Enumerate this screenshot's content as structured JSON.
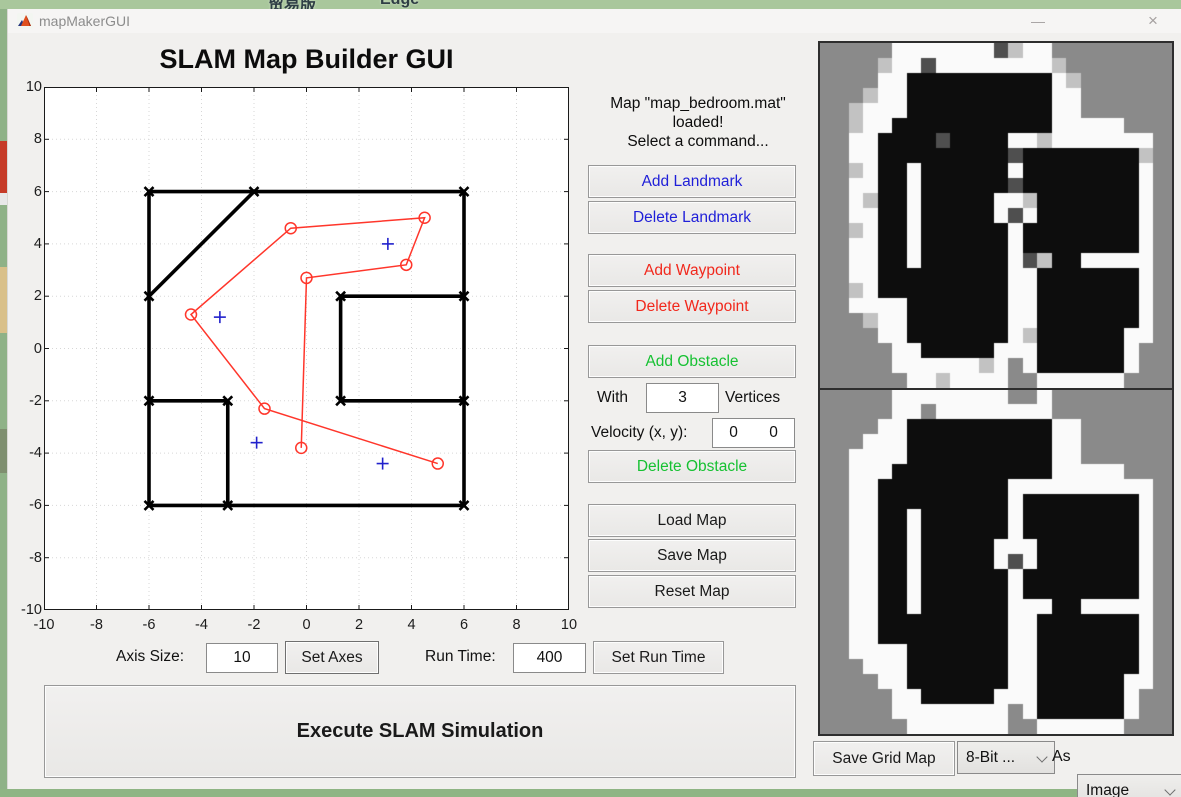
{
  "desktop": {
    "top_text_left": "贸易版",
    "top_text_right": "Edge"
  },
  "window": {
    "title": "mapMakerGUI",
    "minimize": "—",
    "close": "×"
  },
  "app": {
    "title": "SLAM Map Builder GUI"
  },
  "status": {
    "lines": [
      "Map \"map_bedroom.mat\"",
      "loaded!",
      "Select a command..."
    ]
  },
  "landmark_buttons": {
    "add": "Add Landmark",
    "delete": "Delete Landmark"
  },
  "waypoint_buttons": {
    "add": "Add Waypoint",
    "delete": "Delete Waypoint"
  },
  "obstacle": {
    "add": "Add Obstacle",
    "with_label": "With",
    "vertices_value": "3",
    "vertices_label": "Vertices",
    "velocity_label": "Velocity (x, y):",
    "velocity_x": "0",
    "velocity_y": "0",
    "delete": "Delete Obstacle"
  },
  "map_buttons": {
    "load": "Load Map",
    "save": "Save Map",
    "reset": "Reset Map"
  },
  "axis_controls": {
    "axis_size_label": "Axis Size:",
    "axis_size_value": "10",
    "set_axes": "Set Axes",
    "run_time_label": "Run Time:",
    "run_time_value": "400",
    "set_run_time": "Set Run Time"
  },
  "execute": {
    "label": "Execute SLAM Simulation"
  },
  "grid_export": {
    "save": "Save Grid Map",
    "bit_depth": "8-Bit ...",
    "as_label": "As",
    "format": "Image"
  },
  "chart_data": {
    "type": "scatter",
    "title": "",
    "xlabel": "",
    "ylabel": "",
    "xlim": [
      -10,
      10
    ],
    "ylim": [
      -10,
      10
    ],
    "xticks": [
      -10,
      -8,
      -6,
      -4,
      -2,
      0,
      2,
      4,
      6,
      8,
      10
    ],
    "yticks": [
      -10,
      -8,
      -6,
      -4,
      -2,
      0,
      2,
      4,
      6,
      8,
      10
    ],
    "grid": true,
    "walls": [
      [
        -6,
        6,
        6,
        6
      ],
      [
        -6,
        6,
        -6,
        -6
      ],
      [
        6,
        6,
        6,
        -6
      ],
      [
        -6,
        -6,
        6,
        -6
      ],
      [
        -2,
        6,
        -6,
        2
      ],
      [
        1.3,
        2,
        6,
        2
      ],
      [
        1.3,
        2,
        1.3,
        -2
      ],
      [
        1.3,
        -2,
        6,
        -2
      ],
      [
        -6,
        -2,
        -3,
        -2
      ],
      [
        -3,
        -2,
        -3,
        -6
      ]
    ],
    "wall_markers": [
      [
        -6,
        6
      ],
      [
        -2,
        6
      ],
      [
        6,
        6
      ],
      [
        -6,
        2
      ],
      [
        6,
        2
      ],
      [
        1.3,
        2
      ],
      [
        1.3,
        -2
      ],
      [
        6,
        -2
      ],
      [
        -6,
        -2
      ],
      [
        -3,
        -2
      ],
      [
        -6,
        -6
      ],
      [
        -3,
        -6
      ],
      [
        6,
        -6
      ]
    ],
    "waypoints": [
      [
        -0.2,
        -3.8
      ],
      [
        0,
        2.7
      ],
      [
        3.8,
        3.2
      ],
      [
        4.5,
        5.0
      ],
      [
        -0.6,
        4.6
      ],
      [
        -4.4,
        1.3
      ],
      [
        -1.6,
        -2.3
      ],
      [
        5.0,
        -4.4
      ]
    ],
    "landmarks": [
      [
        3.1,
        4.0
      ],
      [
        -3.3,
        1.2
      ],
      [
        -1.9,
        -3.6
      ],
      [
        2.9,
        -4.4
      ]
    ],
    "colors": {
      "wall": "#000000",
      "waypoint": "#ff362b",
      "landmark": "#2121cc",
      "grid": "#d7d7d7",
      "box": "#1a1a1a"
    }
  },
  "grid_maps": {
    "palette": {
      "G": "#8a8a8a",
      "W": "#fafafa",
      "B": "#0d0d0d",
      "D": "#4f4f4f",
      "L": "#c2c2c2"
    },
    "top": [
      "GGGGGWWWWWWWDLWWGGGGGGGG",
      "GGGGLWWDWWWWWWWWLGGGGGGG",
      "GGGGWWBBBBBBBBBBWLGGGGGG",
      "GGGLWWBBBBBBBBBBWWGGGGGG",
      "GGLWWWBBBBBBBBBBWWGGGGGG",
      "GGLWWBBBBBBBBBBBWWWWWGGG",
      "GGWWBBBBDBBBBWWLWWWWWWWG",
      "GGWWBBBBBBBBBDBBBBBBBBLG",
      "GGLWBBWBBBBBBWBBBBBBBBWG",
      "GGWWBBWBBBBBBDBBBBBBBBWG",
      "GGWLBBWBBBBBWWLBBBBBBBWG",
      "GGWWBBWBBBBBWDWBBBBBBBWG",
      "GGLWBBWBBBBBBWBBBBBBBBWG",
      "GGWWBBWBBBBBBWBBBBBBBBWG",
      "GGWWBBWBBBBBBWDLBBWWWWWG",
      "GGWWBBBBBBBBBWWBBBBBBBWG",
      "GGLWBBBBBBBBBWWBBBBBBBWG",
      "GGWWWWBBBBBBBWWBBBBBBBWG",
      "GGGLWWBBBBBBBWWBBBBBBBWG",
      "GGGGWWBBBBBBBWLBBBBBBWWG",
      "GGGGGWWBBBBBWWWBBBBBBWGG",
      "GGGGGWWWWWWLWGWBBBBBBWGG",
      "GGGGGGWWLWWWWGGWWWWWWGGG"
    ],
    "bottom": [
      "GGGGGWWWWWWWWGGWGGGGGGGG",
      "GGGGGWWGWWWWWWWWGGGGGGGG",
      "GGGGWWBBBBBBBBBBWWGGGGGG",
      "GGGWWWBBBBBBBBBBWWGGGGGG",
      "GGWWWWBBBBBBBBBBWWGGGGGG",
      "GGWWWBBBBBBBBBBBWWWWWGGG",
      "GGWWBBBBBBBBBWWWWWWWWWWG",
      "GGWWBBBBBBBBBWBBBBBBBBWG",
      "GGWWBBWBBBBBBWBBBBBBBBWG",
      "GGWWBBWBBBBBBWBBBBBBBBWG",
      "GGWWBBWBBBBBWWWBBBBBBBWG",
      "GGWWBBWBBBBBWDWBBBBBBBWG",
      "GGWWBBWBBBBBBWBBBBBBBBWG",
      "GGWWBBWBBBBBBWBBBBBBBBWG",
      "GGWWBBWBBBBBBWWWBBWWWWWG",
      "GGWWBBBBBBBBBWWBBBBBBBWG",
      "GGWWBBBBBBBBBWWBBBBBBBWG",
      "GGWWWWBBBBBBBWWBBBBBBBWG",
      "GGGWWWBBBBBBBWWBBBBBBBWG",
      "GGGGWWBBBBBBBWWBBBBBBWWG",
      "GGGGGWWBBBBBWWWBBBBBBWGG",
      "GGGGGWWWWWWWWGWBBBBBBWGG",
      "GGGGGGWWWWWWWGGWWWWWWGGG"
    ]
  }
}
